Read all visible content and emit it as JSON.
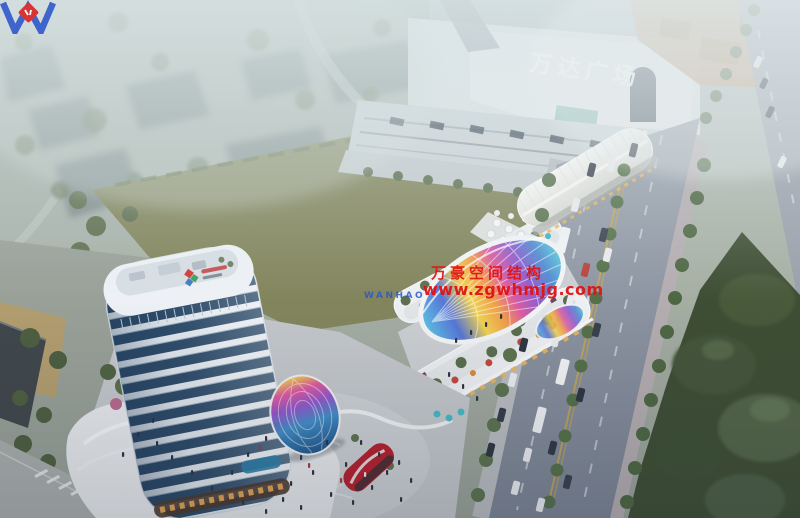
{
  "scene": {
    "mall_sign": "万达广场",
    "watermark": {
      "brand": "WANHAO",
      "company": "万豪空间结构",
      "website": "www.zgwhmjg.com",
      "red": "#e11313",
      "blue": "#2b55cc"
    },
    "palette": {
      "haze": "#dce7e9",
      "field_green": "#82855c",
      "lawn_dark": "#3e4e34",
      "road_grey": "#8d94a1",
      "tower_glass": "#2e4c6a",
      "tower_band": "#e9eef3",
      "arch_roof_white": "#f4f4f1",
      "canopy_rainbow": [
        "#55b8e2",
        "#4f6fd4",
        "#f0d04a",
        "#f09a42",
        "#d8549e",
        "#8a54cc",
        "#4a86d0",
        "#55c0d8"
      ]
    }
  }
}
